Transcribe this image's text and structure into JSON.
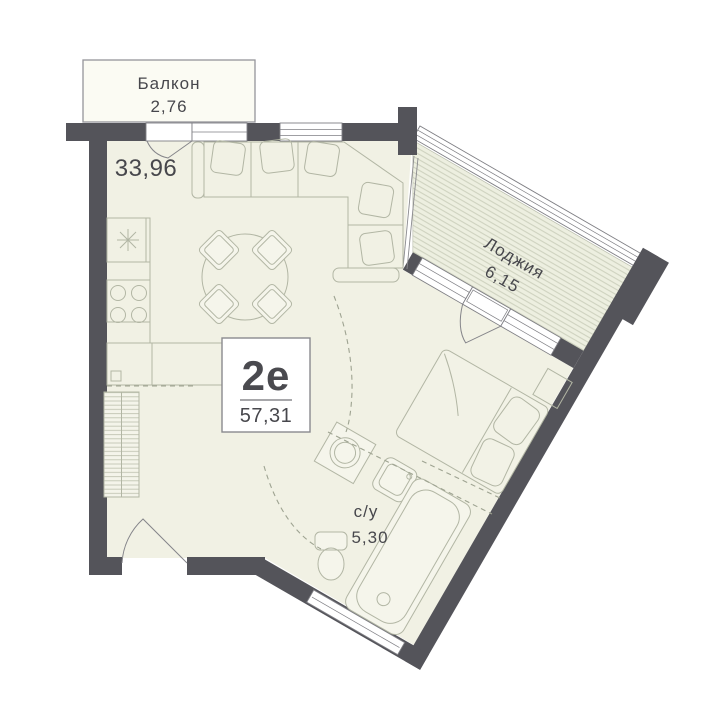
{
  "apartment": {
    "type_label": "2е",
    "total_area": "57,31",
    "rooms": {
      "balcony": {
        "name": "Балкон",
        "area": "2,76"
      },
      "living_room": {
        "area": "33,96"
      },
      "loggia": {
        "name": "Лоджия",
        "area": "6,15"
      },
      "bathroom": {
        "name": "с/у",
        "area": "5,30"
      }
    }
  },
  "colors": {
    "wall": "#54545A",
    "floor": "#F1F1E4",
    "loggia_floor": "#EDEFE0",
    "furniture_line": "#B2B6A4",
    "text": "#47474C",
    "background": "#FFFFFF"
  }
}
